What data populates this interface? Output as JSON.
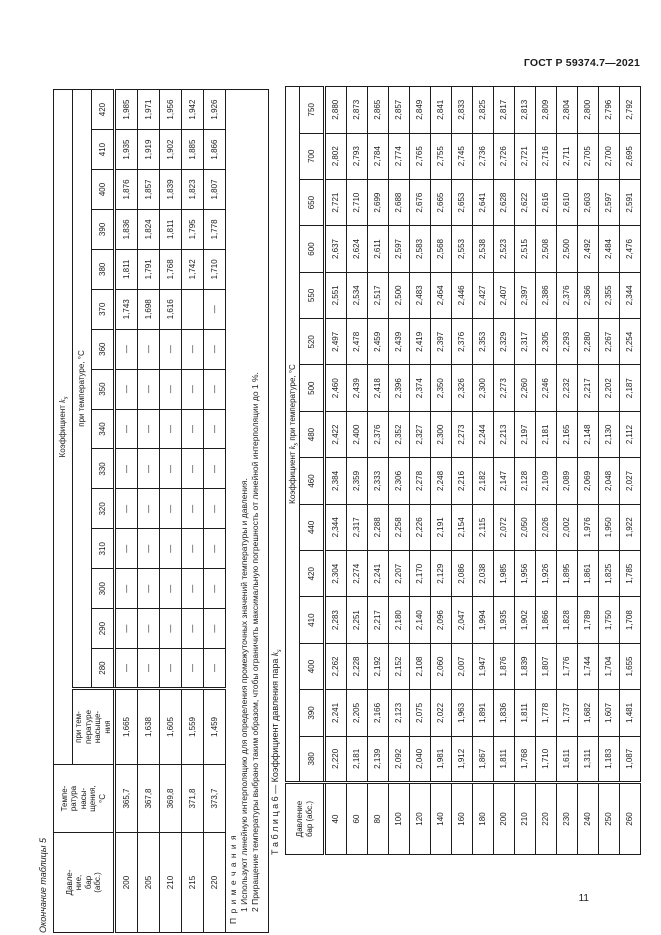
{
  "page": {
    "header": "ГОСТ Р 59374.7—2021",
    "page_number": "11"
  },
  "table5": {
    "caption": "Окончание таблицы 5",
    "headers": {
      "pressure": "Давле-\nние,\nбар\n(абс.)",
      "sat_temp": "Темпе-\nратура\nнасы-\nщения,\n°С",
      "coef_prefix": "Коэффициент ",
      "coef_k": "k",
      "coef_sub": "s",
      "at_saturation": "при тем-\nпературе\nнасыще-\nния",
      "at_temperature": "при температуре, °С",
      "temps": [
        "280",
        "290",
        "300",
        "310",
        "320",
        "330",
        "340",
        "350",
        "360",
        "370",
        "380",
        "390",
        "400",
        "410",
        "420"
      ]
    },
    "rows": [
      {
        "p": "200",
        "tsat": "365,7",
        "ksat": "1,665",
        "vals": [
          "—",
          "—",
          "—",
          "—",
          "—",
          "—",
          "—",
          "—",
          "—",
          "1,743",
          "1,811",
          "1,836",
          "1,876",
          "1,935",
          "1,985"
        ]
      },
      {
        "p": "205",
        "tsat": "367,8",
        "ksat": "1,638",
        "vals": [
          "—",
          "—",
          "—",
          "—",
          "—",
          "—",
          "—",
          "—",
          "—",
          "1,698",
          "1,791",
          "1,824",
          "1,857",
          "1,919",
          "1,971"
        ]
      },
      {
        "p": "210",
        "tsat": "369,8",
        "ksat": "1,605",
        "vals": [
          "—",
          "—",
          "—",
          "—",
          "—",
          "—",
          "—",
          "—",
          "—",
          "1,616",
          "1,768",
          "1,811",
          "1,839",
          "1,902",
          "1,956"
        ]
      },
      {
        "p": "215",
        "tsat": "371,8",
        "ksat": "1,559",
        "vals": [
          "—",
          "—",
          "—",
          "—",
          "—",
          "—",
          "—",
          "—",
          "—",
          "",
          "1,742",
          "1,795",
          "1,823",
          "1,885",
          "1,942"
        ]
      },
      {
        "p": "220",
        "tsat": "373,7",
        "ksat": "1,459",
        "vals": [
          "—",
          "—",
          "—",
          "—",
          "—",
          "—",
          "—",
          "—",
          "—",
          "—",
          "1,710",
          "1,778",
          "1,807",
          "1,866",
          "1,926"
        ]
      }
    ],
    "notes": {
      "title": "П р и м е ч а н и я",
      "items": [
        "1 Используют линейную интерполяцию для определения промежуточных значений температуры и давления.",
        "2 Приращение температуры выбрано таким образом, чтобы ограничить максимальную погрешность от линейной интерполяции до 1 %."
      ]
    }
  },
  "table6": {
    "caption_label": "Т а б л и ц а   6",
    "caption_rest": " — Коэффициент давления пара ",
    "caption_k": "k",
    "caption_sub": "s",
    "headers": {
      "pressure": "Давление\nбар (абс.)",
      "coef_prefix": "Коэффициент ",
      "coef_k": "k",
      "coef_sub": "s",
      "coef_suffix": " при температуре, °С",
      "temps": [
        "380",
        "390",
        "400",
        "410",
        "420",
        "440",
        "460",
        "480",
        "500",
        "520",
        "550",
        "600",
        "650",
        "700",
        "750"
      ]
    },
    "rows": [
      {
        "p": "40",
        "vals": [
          "2,220",
          "2,241",
          "2,262",
          "2,283",
          "2,304",
          "2,344",
          "2,384",
          "2,422",
          "2,460",
          "2,497",
          "2,551",
          "2,637",
          "2,721",
          "2,802",
          "2,880"
        ]
      },
      {
        "p": "60",
        "vals": [
          "2,181",
          "2,205",
          "2,228",
          "2,251",
          "2,274",
          "2,317",
          "2,359",
          "2,400",
          "2,439",
          "2,478",
          "2,534",
          "2,624",
          "2,710",
          "2,793",
          "2,873"
        ]
      },
      {
        "p": "80",
        "vals": [
          "2,139",
          "2,166",
          "2,192",
          "2,217",
          "2,241",
          "2,288",
          "2,333",
          "2,376",
          "2,418",
          "2,459",
          "2,517",
          "2,611",
          "2,699",
          "2,784",
          "2,865"
        ]
      },
      {
        "p": "100",
        "vals": [
          "2,092",
          "2,123",
          "2,152",
          "2,180",
          "2,207",
          "2,258",
          "2,306",
          "2,352",
          "2,396",
          "2,439",
          "2,500",
          "2,597",
          "2,688",
          "2,774",
          "2,857"
        ]
      },
      {
        "p": "120",
        "vals": [
          "2,040",
          "2,075",
          "2,108",
          "2,140",
          "2,170",
          "2,226",
          "2,278",
          "2,327",
          "2,374",
          "2,419",
          "2,483",
          "2,583",
          "2,676",
          "2,765",
          "2,849"
        ]
      },
      {
        "p": "140",
        "vals": [
          "1,981",
          "2,022",
          "2,060",
          "2,096",
          "2,129",
          "2,191",
          "2,248",
          "2,300",
          "2,350",
          "2,397",
          "2,464",
          "2,568",
          "2,665",
          "2,755",
          "2,841"
        ]
      },
      {
        "p": "160",
        "vals": [
          "1,912",
          "1,963",
          "2,007",
          "2,047",
          "2,086",
          "2,154",
          "2,216",
          "2,273",
          "2,326",
          "2,376",
          "2,446",
          "2,553",
          "2,653",
          "2,745",
          "2,833"
        ]
      },
      {
        "p": "180",
        "vals": [
          "1,867",
          "1,891",
          "1,947",
          "1,994",
          "2,038",
          "2,115",
          "2,182",
          "2,244",
          "2,300",
          "2,353",
          "2,427",
          "2,538",
          "2,641",
          "2,736",
          "2,825"
        ]
      },
      {
        "p": "200",
        "vals": [
          "1,811",
          "1,836",
          "1,876",
          "1,935",
          "1,985",
          "2,072",
          "2,147",
          "2,213",
          "2,273",
          "2,329",
          "2,407",
          "2,523",
          "2,628",
          "2,726",
          "2,817"
        ]
      },
      {
        "p": "210",
        "vals": [
          "1,768",
          "1,811",
          "1,839",
          "1,902",
          "1,956",
          "2,050",
          "2,128",
          "2,197",
          "2,260",
          "2,317",
          "2,397",
          "2,515",
          "2,622",
          "2,721",
          "2,813"
        ]
      },
      {
        "p": "220",
        "vals": [
          "1,710",
          "1,778",
          "1,807",
          "1,866",
          "1,926",
          "2,026",
          "2,109",
          "2,181",
          "2,246",
          "2,305",
          "2,386",
          "2,508",
          "2,616",
          "2,716",
          "2,809"
        ]
      },
      {
        "p": "230",
        "vals": [
          "1,611",
          "1,737",
          "1,776",
          "1,828",
          "1,895",
          "2,002",
          "2,089",
          "2,165",
          "2,232",
          "2,293",
          "2,376",
          "2,500",
          "2,610",
          "2,711",
          "2,804"
        ]
      },
      {
        "p": "240",
        "vals": [
          "1,311",
          "1,682",
          "1,744",
          "1,789",
          "1,861",
          "1,976",
          "2,069",
          "2,148",
          "2,217",
          "2,280",
          "2,366",
          "2,492",
          "2,603",
          "2,705",
          "2,800"
        ]
      },
      {
        "p": "250",
        "vals": [
          "1,183",
          "1,607",
          "1,704",
          "1,750",
          "1,825",
          "1,950",
          "2,048",
          "2,130",
          "2,202",
          "2,267",
          "2,355",
          "2,484",
          "2,597",
          "2,700",
          "2,796"
        ]
      },
      {
        "p": "260",
        "vals": [
          "1,087",
          "1,481",
          "1,655",
          "1,708",
          "1,785",
          "1,922",
          "2,027",
          "2,112",
          "2,187",
          "2,254",
          "2,344",
          "2,476",
          "2,591",
          "2,695",
          "2,792"
        ]
      }
    ]
  }
}
